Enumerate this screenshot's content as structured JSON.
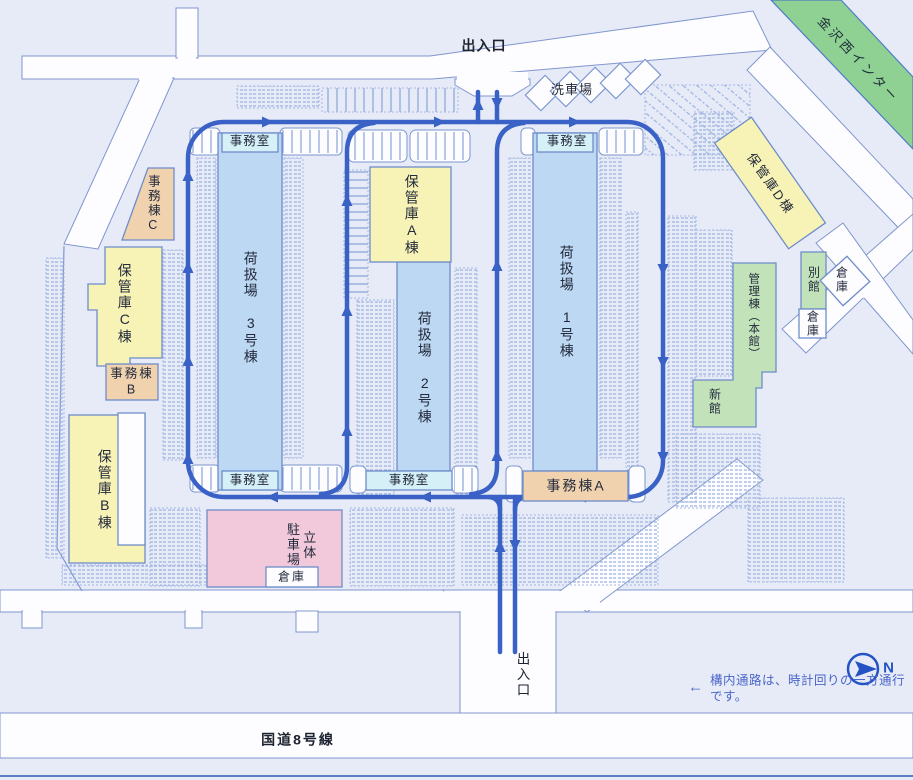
{
  "labels": {
    "entrance_top": "出入口",
    "entrance_bottom": "出入口",
    "car_wash": "洗車場",
    "office_room": "事務室",
    "handling_1": "荷扱場　1号棟",
    "handling_2": "荷扱場　2号棟",
    "handling_3": "荷扱場　3号棟",
    "storage_a": "保管庫A棟",
    "storage_b": "保管庫B棟",
    "storage_c": "保管庫C棟",
    "storage_d": "保管庫D棟",
    "office_bldg_a": "事務棟A",
    "office_bldg_b": "事務棟\nB",
    "office_bldg_c": "事務棟C",
    "admin_main": "管理棟（本館）",
    "new_wing": "新館",
    "annex": "別館",
    "warehouse": "倉庫",
    "parking_deck": "立体\n駐車場",
    "route8": "国道8号線",
    "interchange": "金沢西インター",
    "compass_n": "N",
    "notice_arrow": "←",
    "notice": "構内通路は、時計回りの一方通行です。"
  },
  "colors": {
    "background": "#e6ebf7",
    "road_fill": "#fdfdff",
    "road_stroke": "#8096ce",
    "circulation": "#3a62c6",
    "warehouse_fill": "#bdd8f2",
    "storage_fill": "#f7f3b6",
    "office_fill": "#f0d3ae",
    "admin_fill": "#c2e3ba",
    "parking_deck_fill": "#f2c9da",
    "office_room_fill": "#d6f0f8",
    "interchange_fill": "#8fd192",
    "note_text": "#4a66c8"
  }
}
